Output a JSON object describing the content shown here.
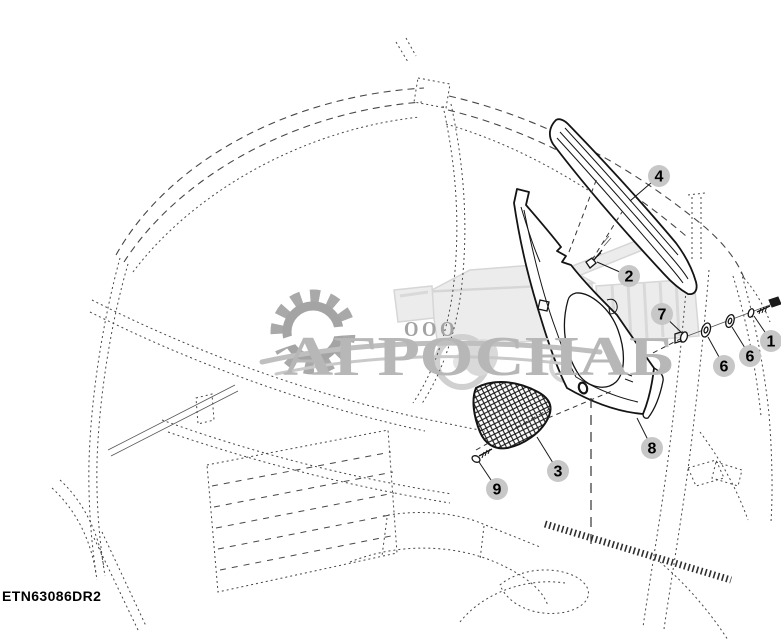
{
  "diagram": {
    "part_code": "ETN63086DR2",
    "subject": "cab corner post trim exploded view"
  },
  "watermark": {
    "company_prefix": "ООО",
    "company_name": "АГРОСНАБ",
    "gear_icon": "gear-icon",
    "vehicle_icon": "combine-harvester-icon",
    "text_color": "#b7b7b7",
    "gear_color": "#a9a9a9"
  },
  "colors": {
    "background": "#ffffff",
    "part_line": "#141414",
    "wireframe_line": "#474747",
    "callout_circle": "#c7c7c7",
    "callout_number": "#000000"
  },
  "callouts": [
    {
      "label": "4",
      "x": 659,
      "y": 176,
      "tx": 630,
      "ty": 201
    },
    {
      "label": "2",
      "x": 629,
      "y": 276,
      "tx": 597,
      "ty": 262
    },
    {
      "label": "7",
      "x": 662,
      "y": 314,
      "tx": 683,
      "ty": 334
    },
    {
      "label": "6",
      "x": 724,
      "y": 366,
      "tx": 708,
      "ty": 337
    },
    {
      "label": "6",
      "x": 750,
      "y": 356,
      "tx": 732,
      "ty": 327
    },
    {
      "label": "1",
      "x": 771,
      "y": 341,
      "tx": 754,
      "ty": 316
    },
    {
      "label": "8",
      "x": 652,
      "y": 448,
      "tx": 637,
      "ty": 418
    },
    {
      "label": "3",
      "x": 558,
      "y": 471,
      "tx": 537,
      "ty": 437
    },
    {
      "label": "9",
      "x": 497,
      "y": 489,
      "tx": 479,
      "ty": 462
    }
  ]
}
